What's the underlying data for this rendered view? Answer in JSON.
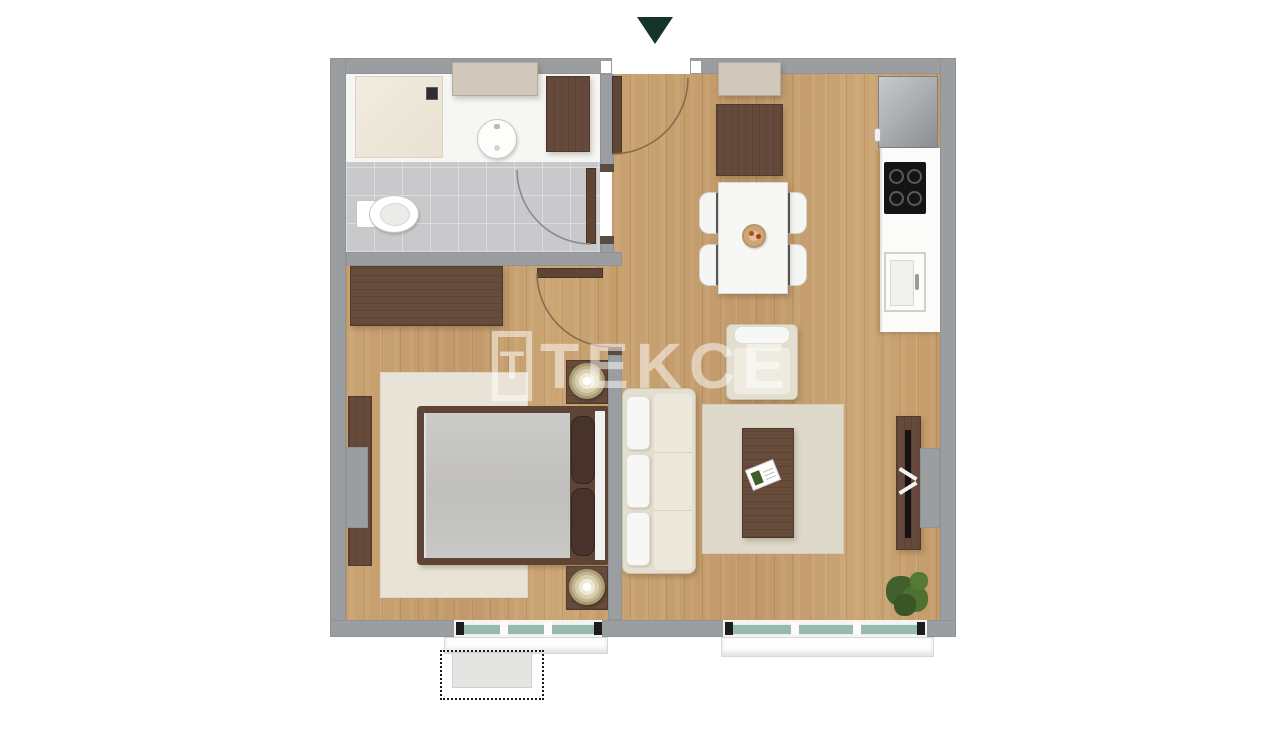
{
  "watermark": {
    "logo_letter": "T",
    "brand": "TEKCE"
  },
  "entrance_marker": {
    "type": "arrow",
    "direction": "down",
    "color": "#16352a"
  },
  "palette": {
    "background": "#ffffff",
    "wall": "#9b9ea1",
    "wood_floor": "#c7a06e",
    "bathroom_tile": "#c9c9cc",
    "shower_tray": "#efe9dc",
    "dark_wood_furniture": "#65493a",
    "upholstery_white": "#f5f5f3",
    "rug_beige": "#e8e3d6",
    "window_glass_teal": "#97b9b1",
    "cooktop_black": "#141414",
    "plant_green": "#4e7031",
    "watermark": "rgba(255,255,255,0.5)"
  },
  "rooms": {
    "bathroom": {
      "fixtures": [
        "shower",
        "shower-drain",
        "wall-cabinet",
        "washbasin",
        "side-cabinet",
        "toilet",
        "door"
      ]
    },
    "entrance_hall": {
      "features": [
        "entrance-door",
        "door-swing",
        "wall-shelf",
        "shoe-cabinet"
      ]
    },
    "kitchen": {
      "appliances": [
        "refrigerator",
        "counter",
        "cooktop-4-burners",
        "sink"
      ]
    },
    "dining_area": {
      "furniture": [
        "table",
        "chair",
        "chair",
        "chair",
        "chair",
        "fruit-bowl",
        "armchair"
      ]
    },
    "bedroom": {
      "furniture": [
        "wardrobe",
        "side-wardrobe",
        "double-bed",
        "pillow",
        "pillow",
        "nightstand",
        "nightstand",
        "lamp",
        "lamp",
        "rug",
        "window",
        "balcony-outline"
      ]
    },
    "living_room": {
      "furniture": [
        "sofa",
        "coffee-table",
        "magazine",
        "rug",
        "tv-unit",
        "tv",
        "plant",
        "window"
      ]
    }
  }
}
